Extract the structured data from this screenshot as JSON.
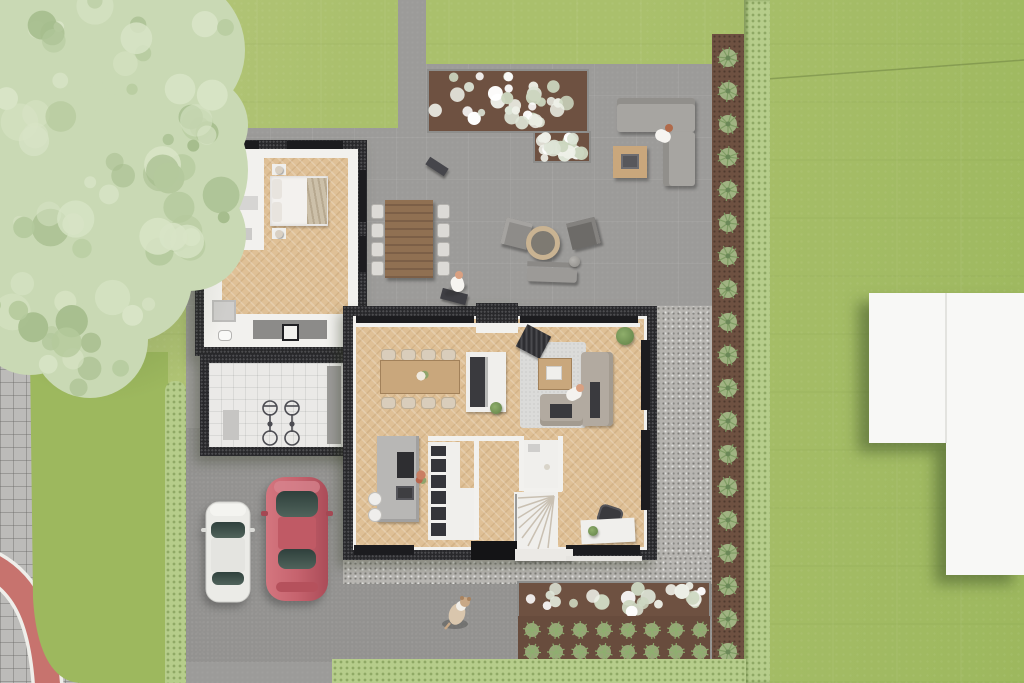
{
  "image_kind": "aerial-top-down-architectural-render",
  "palette": {
    "lawn_light": "#bac983",
    "lawn": "#aac06c",
    "lawn_deep": "#9db85e",
    "patio": "#9c9b99",
    "driveway": "#8f8f8d",
    "sidewalk": "#bcbbb9",
    "bike_path": "#c7736e",
    "curb": "#efeeea",
    "gravel": "#b7b5b1",
    "roof": "#28282b",
    "wall": "#f2f1ee",
    "wood_floor": "#dfc096",
    "tile": "#eae9e7",
    "rug": "#dbdbd9",
    "mulch": "#6e5141",
    "flower": "#eef0e8",
    "flower_dim": "#ccd6bf",
    "shrub": "#a9c48e",
    "shrub_dark": "#7f9c63",
    "hedge": "#b6cd8b",
    "wood_furniture": "#c9a77c",
    "wood_dark": "#8a6a50",
    "sofa_outdoor": "#a7a5a1",
    "sofa_indoor": "#b2aaa0",
    "island": "#b8b7b5",
    "dark_furniture": "#3a3a3e",
    "white_furniture": "#f0efec",
    "building": "#f8f8f6",
    "car_white": "#ebebe7",
    "car_red": "#c6636e",
    "glass": "#3f524c",
    "skin": "#d9a081",
    "tree_base": "#c9d9b4",
    "tree_light": "#d8e4c6",
    "tree_dark": "#b4c99c",
    "tree_deep": "#a6bd8d",
    "shadow_green": "rgba(60,80,40,0.30)"
  },
  "scene": {
    "view": "top-down 3d render of a modern flat-roof house plot",
    "ground_features": [
      "lawn",
      "large tree",
      "stone terrace",
      "driveway",
      "paved sidewalk",
      "red bike path corner",
      "hedges",
      "gravel border",
      "mulch planting strips",
      "white neighbor roof"
    ],
    "house_rooms_visible": [
      "bedroom",
      "wardrobe room",
      "bathroom",
      "utility bike room",
      "living room",
      "dining area",
      "kitchen island",
      "wc",
      "stair hall",
      "office nook"
    ],
    "outdoor_furniture": [
      "slatted dining table with chairs",
      "corner lounge sofa",
      "square coffee table",
      "two lounge chairs",
      "fire bowl",
      "garden bench",
      "dark benches"
    ],
    "vehicles": [
      {
        "type": "car",
        "color_name": "white"
      },
      {
        "type": "car",
        "color_name": "red"
      }
    ],
    "people_count": 3,
    "dog_count": 1,
    "bicycles": 2,
    "generated": {
      "border_shrubs_count": 19,
      "border_shrubs_spacing": 33,
      "veg_rows": 2,
      "veg_per_row": 8,
      "patio_bed_flowers": 58,
      "planter_bed_flowers": 26,
      "nw_bed_flowers": 10,
      "patio_table_chairs_per_side": 4,
      "dining_chairs_per_side": 4,
      "kitchen_stools": 2,
      "tree_mottles": 80
    }
  }
}
